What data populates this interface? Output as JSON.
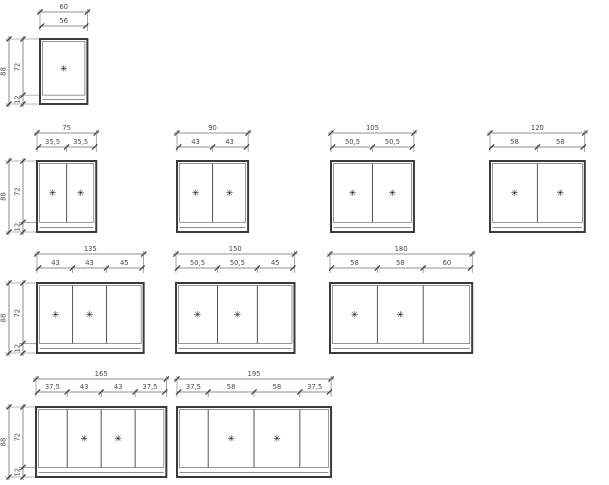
{
  "diagram": {
    "height_dims": {
      "total": "88",
      "door": "72",
      "plinth": "12"
    },
    "knob_icon": "✳",
    "colors": {
      "line": "#6e6e6e",
      "outline": "#3a3a3a",
      "inner": "#6a6a6a",
      "text": "#4a4a4a",
      "knob": "#141414",
      "background": "#ffffff"
    },
    "rows": [
      {
        "cabinets": [
          {
            "total": "60",
            "segments": [
              "56"
            ],
            "knob_doors": [
              0
            ]
          }
        ]
      },
      {
        "cabinets": [
          {
            "total": "75",
            "segments": [
              "35,5",
              "35,5"
            ],
            "knob_doors": [
              0,
              1
            ]
          },
          {
            "total": "90",
            "segments": [
              "43",
              "43"
            ],
            "knob_doors": [
              0,
              1
            ]
          },
          {
            "total": "105",
            "segments": [
              "50,5",
              "50,5"
            ],
            "knob_doors": [
              0,
              1
            ]
          },
          {
            "total": "120",
            "segments": [
              "58",
              "58"
            ],
            "knob_doors": [
              0,
              1
            ]
          }
        ]
      },
      {
        "cabinets": [
          {
            "total": "135",
            "segments": [
              "43",
              "43",
              "45"
            ],
            "knob_doors": [
              0,
              1
            ]
          },
          {
            "total": "150",
            "segments": [
              "50,5",
              "50,5",
              "45"
            ],
            "knob_doors": [
              0,
              1
            ]
          },
          {
            "total": "180",
            "segments": [
              "58",
              "58",
              "60"
            ],
            "knob_doors": [
              0,
              1
            ]
          }
        ]
      },
      {
        "cabinets": [
          {
            "total": "165",
            "segments": [
              "37,5",
              "43",
              "43",
              "37,5"
            ],
            "knob_doors": [
              1,
              2
            ]
          },
          {
            "total": "195",
            "segments": [
              "37,5",
              "58",
              "58",
              "37,5"
            ],
            "knob_doors": [
              1,
              2
            ]
          }
        ]
      }
    ]
  }
}
